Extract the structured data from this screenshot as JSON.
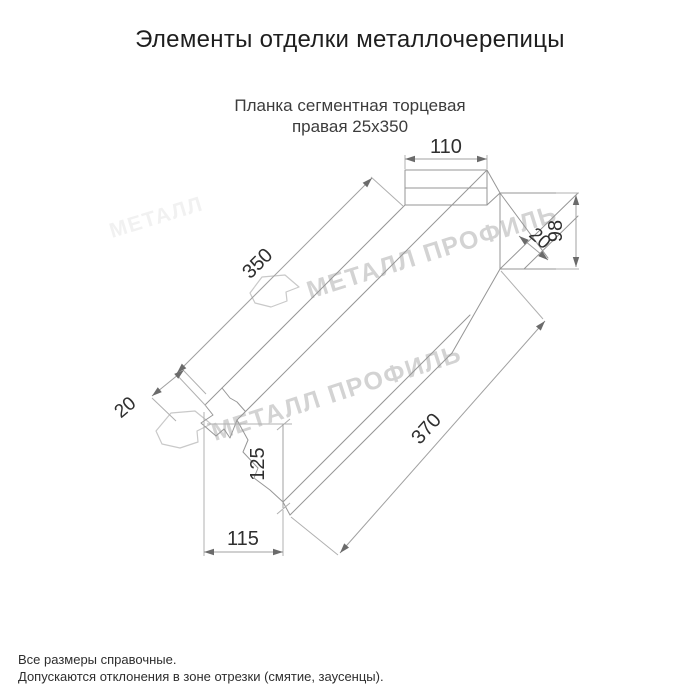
{
  "window": {
    "background": "#ffffff"
  },
  "header": {
    "title": "Элементы отделки металлочерепицы"
  },
  "product": {
    "name_line1": "Планка сегментная торцевая",
    "name_line2": "правая 25x350"
  },
  "drawing": {
    "type": "technical-dimension-drawing",
    "dimensions": [
      {
        "value": "110",
        "measures": "top-flange-width"
      },
      {
        "value": "98",
        "measures": "right-end-height"
      },
      {
        "value": "20",
        "measures": "right-end-hem-width"
      },
      {
        "value": "350",
        "measures": "upper-edge-length"
      },
      {
        "value": "370",
        "measures": "lower-edge-length"
      },
      {
        "value": "20",
        "measures": "left-end-cut-zone"
      },
      {
        "value": "125",
        "measures": "bottom-end-height"
      },
      {
        "value": "115",
        "measures": "bottom-end-width"
      }
    ],
    "watermark_text": "МЕТАЛЛ ПРОФИЛЬ",
    "watermark_fragment": "МЕТАЛЛ",
    "colors": {
      "outline": "#969696",
      "dimension_lines": "#a0a0a0",
      "dimension_text": "#2f2f2f",
      "watermark": "#d3d3d3"
    }
  },
  "footer": {
    "line1": "Все размеры справочные.",
    "line2": "Допускаются отклонения в зоне отрезки (смятие, заусенцы)."
  }
}
